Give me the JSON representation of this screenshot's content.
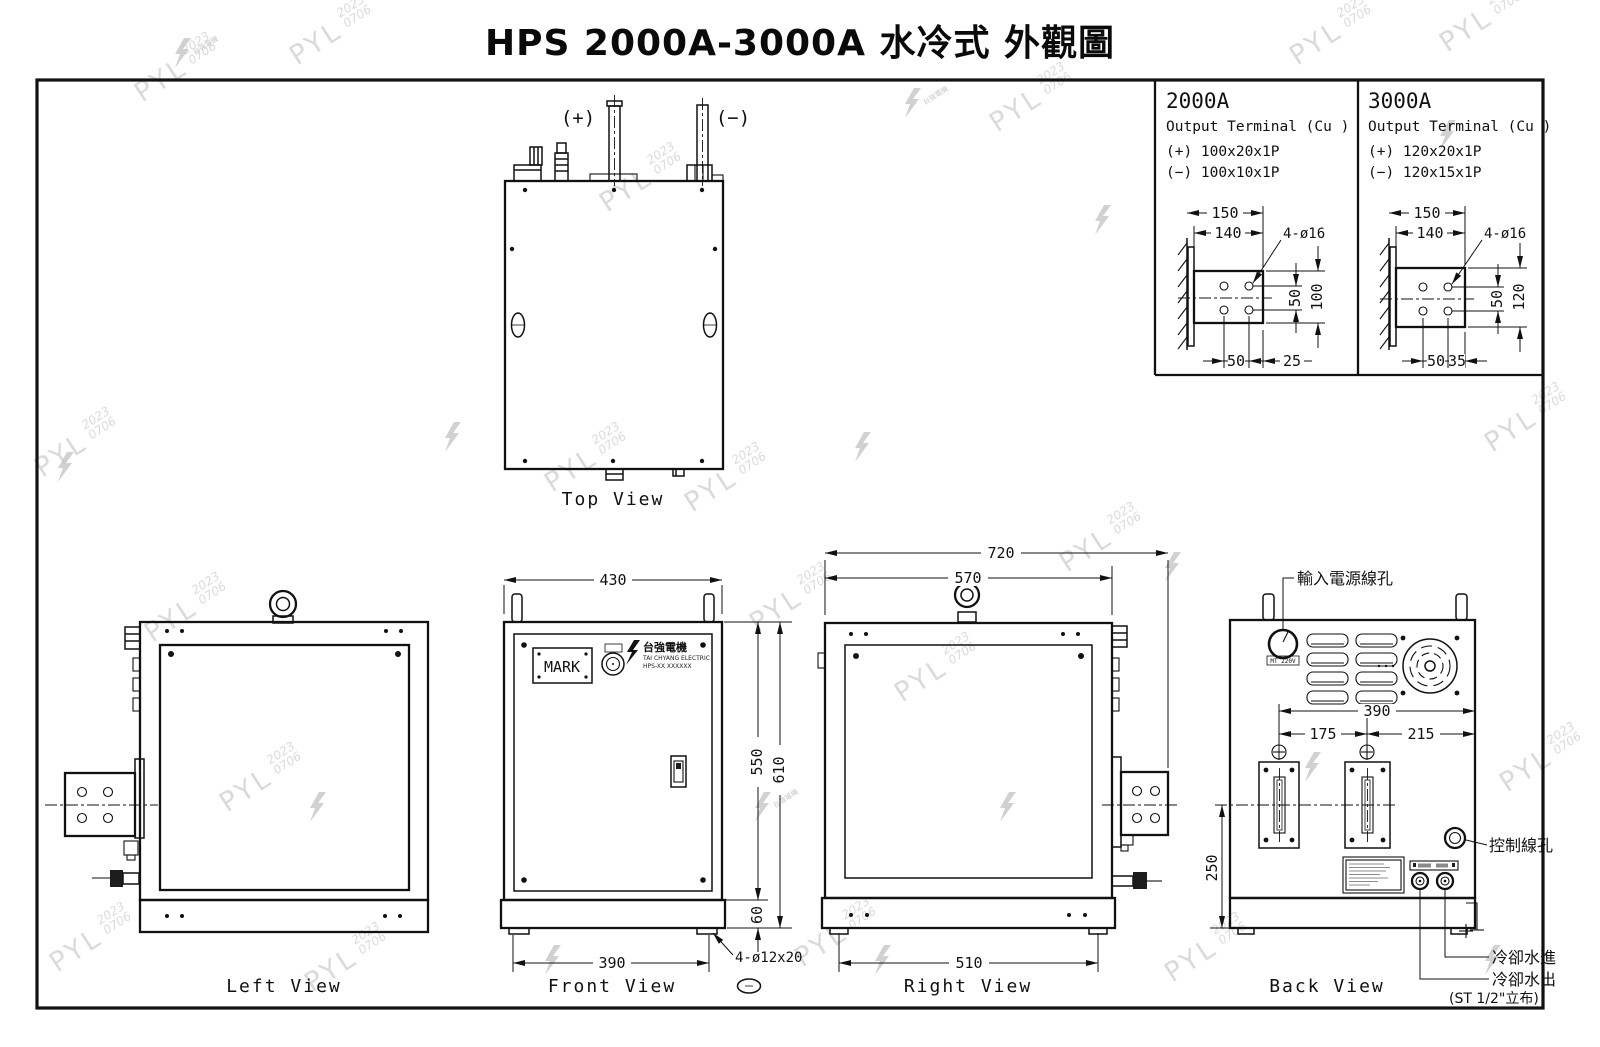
{
  "title": "HPS 2000A-3000A 水冷式 外觀圖",
  "watermark": {
    "pyl": "PYL",
    "year": "2023",
    "code": "0706",
    "company": "台強電機"
  },
  "detail_panels": {
    "p2000": {
      "model": "2000A",
      "subtitle": "Output Terminal (Cu )",
      "plus_spec": "(+) 100x20x1P",
      "minus_spec": "(−) 100x10x1P",
      "dim_width": "150",
      "dim_width2": "140",
      "hole_note": "4-ø16",
      "dim_pitch_v": "50",
      "dim_height": "100",
      "dim_pitch_h": "50",
      "dim_edge": "25"
    },
    "p3000": {
      "model": "3000A",
      "subtitle": "Output Terminal (Cu )",
      "plus_spec": "(+) 120x20x1P",
      "minus_spec": "(−) 120x15x1P",
      "dim_width": "150",
      "dim_width2": "140",
      "hole_note": "4-ø16",
      "dim_pitch_v": "50",
      "dim_height": "120",
      "dim_pitch_h": "50",
      "dim_edge": "35"
    }
  },
  "top_view": {
    "label": "Top View",
    "plus": "(+)",
    "minus": "(−)"
  },
  "left_view": {
    "label": "Left View"
  },
  "front_view": {
    "label": "Front View",
    "mark": "MARK",
    "logo_cn": "台強電機",
    "logo_en": "TAI CHYANG ELECTRIC",
    "logo_model": "HPS-XX XXXXXX",
    "dim_430": "430",
    "dim_550": "550",
    "dim_610": "610",
    "dim_60": "60",
    "dim_390": "390",
    "slot_note": "4-ø12x20"
  },
  "right_view": {
    "label": "Right View",
    "dim_720": "720",
    "dim_570": "570",
    "dim_510": "510"
  },
  "back_view": {
    "label": "Back View",
    "dim_390": "390",
    "dim_175": "175",
    "dim_215": "215",
    "dim_250": "250",
    "power_hole": "輸入電源線孔",
    "ctrl_hole": "控制線孔",
    "water_in": "冷卻水進",
    "water_out": "冷卻水出",
    "water_spec": "(ST 1/2\"立布)",
    "inlet_label": "MT 220V"
  }
}
